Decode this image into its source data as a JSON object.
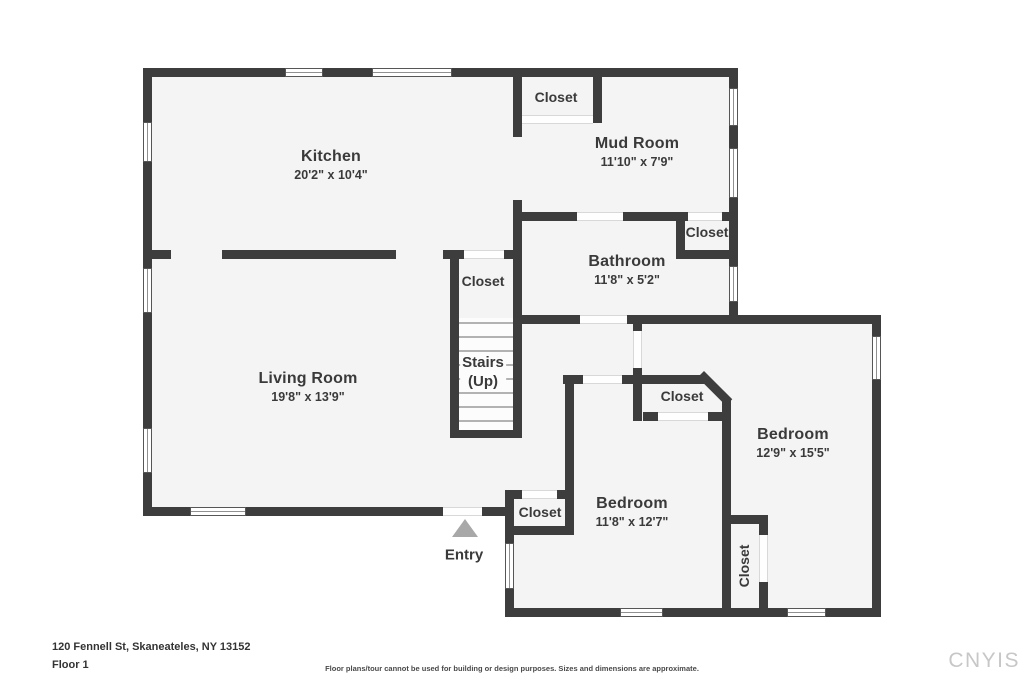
{
  "rooms": {
    "kitchen": {
      "name": "Kitchen",
      "dims": "20'2\" x 10'4\""
    },
    "mud_room": {
      "name": "Mud Room",
      "dims": "11'10\" x 7'9\""
    },
    "bathroom": {
      "name": "Bathroom",
      "dims": "11'8\" x 5'2\""
    },
    "living_room": {
      "name": "Living Room",
      "dims": "19'8\" x 13'9\""
    },
    "bedroom_right": {
      "name": "Bedroom",
      "dims": "12'9\" x 15'5\""
    },
    "bedroom_bottom": {
      "name": "Bedroom",
      "dims": "11'8\" x 12'7\""
    }
  },
  "labels": {
    "closet": "Closet",
    "stairs_line1": "Stairs",
    "stairs_line2": "(Up)",
    "entry": "Entry"
  },
  "footer": {
    "address": "120 Fennell St, Skaneateles, NY 13152",
    "floor": "Floor 1",
    "disclaimer": "Floor plans/tour cannot be used for building or design purposes. Sizes and dimensions are approximate.",
    "watermark": "CNYIS"
  },
  "colors": {
    "wall": "#3d3d3d",
    "floor": "#f4f4f4",
    "text": "#3a3a3a",
    "entry_marker": "#a8a8a8",
    "watermark": "#c7c7c7"
  }
}
